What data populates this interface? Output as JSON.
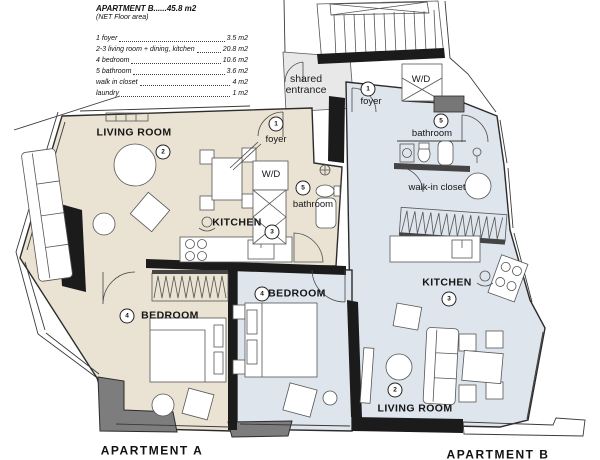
{
  "legend": {
    "title": "APARTMENT B......45.8 m2",
    "subtitle": "(NET Floor area)",
    "items": [
      {
        "name": "1 foyer",
        "area": "3.5 m2"
      },
      {
        "name": "2-3 living room + dining, kitchen",
        "area": "20.8 m2"
      },
      {
        "name": "4 bedroom",
        "area": "10.6 m2"
      },
      {
        "name": "5 bathroom",
        "area": "3.6 m2"
      },
      {
        "name": "walk in closet",
        "area": "4 m2"
      },
      {
        "name": "laundry",
        "area": "1 m2"
      }
    ]
  },
  "entrance": {
    "line1": "shared",
    "line2": "entrance"
  },
  "apartment_a": {
    "name": "APARTMENT A",
    "foyer": {
      "label": "foyer",
      "num": "1"
    },
    "living_room": {
      "label": "LIVING ROOM",
      "num": "2"
    },
    "kitchen": {
      "label": "KITCHEN",
      "num": "3"
    },
    "bedroom": {
      "label": "BEDROOM",
      "num": "4"
    },
    "bathroom": {
      "label": "bathroom",
      "num": "5"
    },
    "wd": {
      "label": "W/D"
    }
  },
  "apartment_b": {
    "name": "APARTMENT B",
    "foyer": {
      "label": "foyer",
      "num": "1"
    },
    "living_room": {
      "label": "LIVING ROOM",
      "num": "2"
    },
    "kitchen": {
      "label": "KITCHEN",
      "num": "3"
    },
    "bedroom": {
      "label": "BEDROOM",
      "num": "4"
    },
    "bathroom": {
      "label": "bathroom",
      "num": "5"
    },
    "walk_in_closet": {
      "label": "walk-in closet"
    },
    "wd": {
      "label": "W/D"
    }
  },
  "colors": {
    "floor_a": "#EAE2D2",
    "floor_b": "#DEE5EC",
    "floor_entry": "#E8E8E8",
    "wall": "#1b1b1b",
    "balcony": "#7d7d7d"
  }
}
